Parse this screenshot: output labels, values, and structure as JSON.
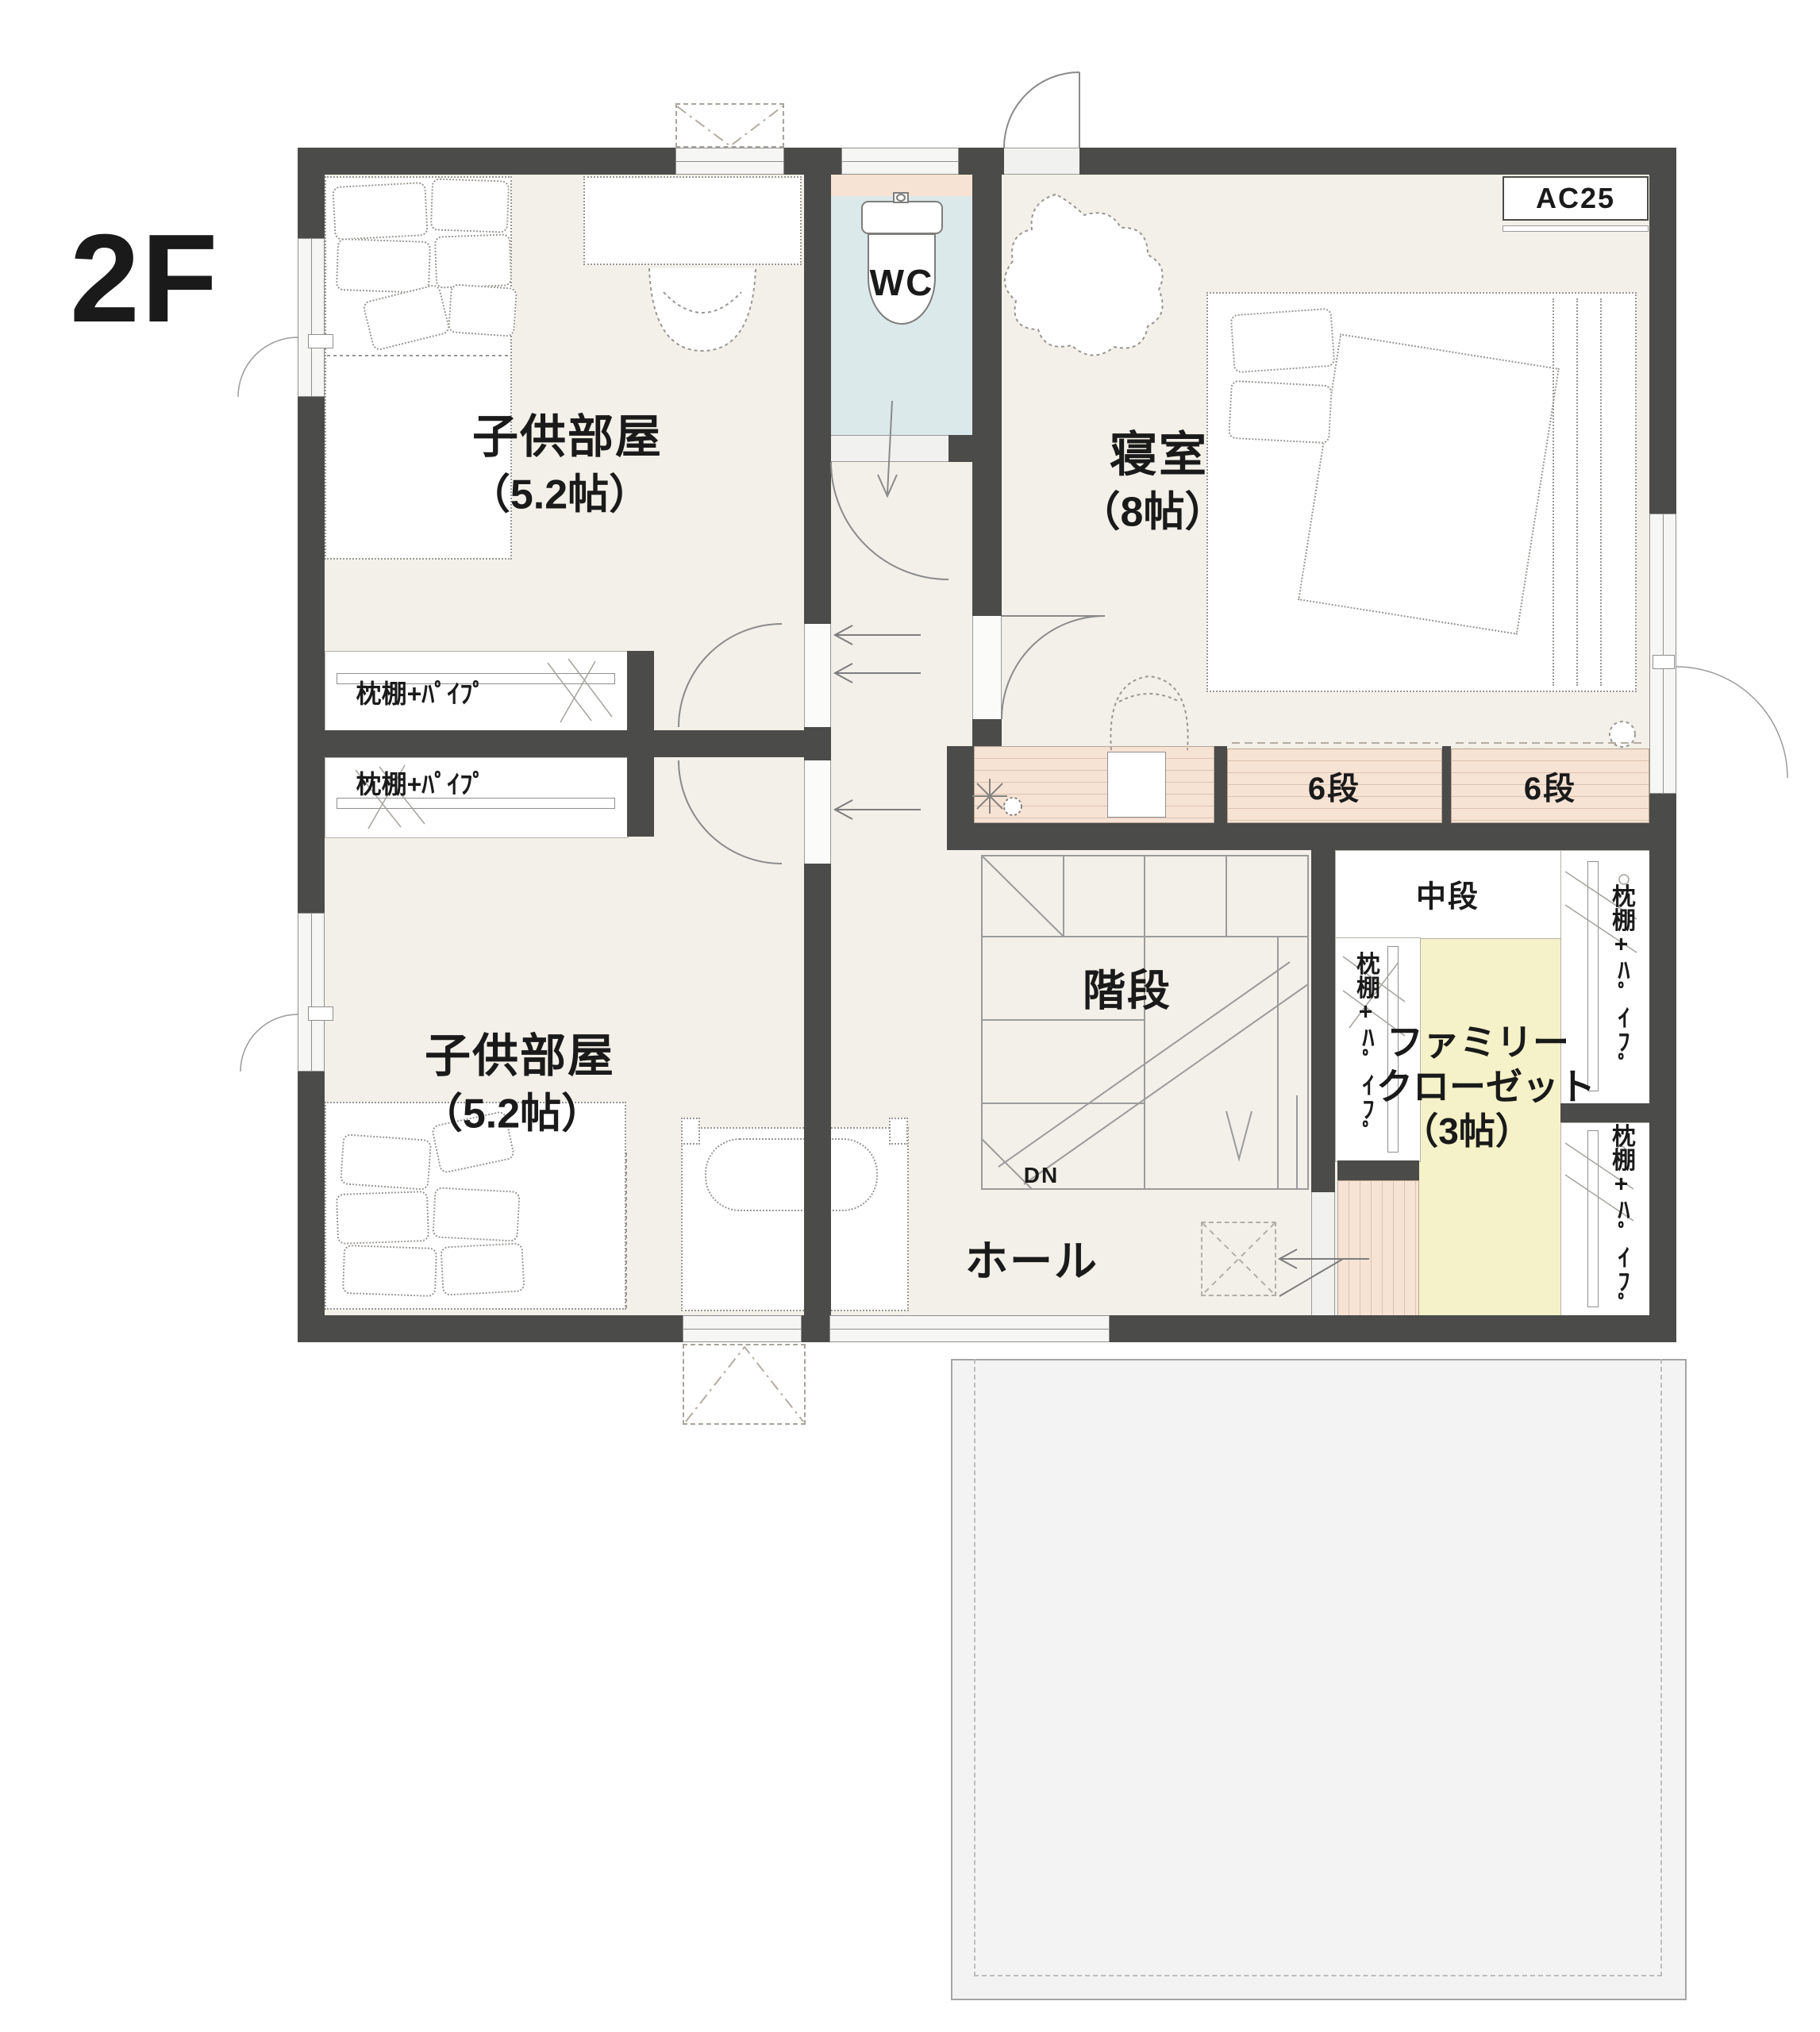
{
  "floor_label": "2F",
  "rooms": {
    "kids_room_1": {
      "name": "子供部屋",
      "size": "（5.2帖）"
    },
    "kids_room_2": {
      "name": "子供部屋",
      "size": "（5.2帖）"
    },
    "bedroom": {
      "name": "寝室",
      "size": "（8帖）"
    },
    "wc": {
      "label": "WC"
    },
    "hall": {
      "label": "ホール"
    },
    "stairs": {
      "label": "階段",
      "down_label": "DN"
    },
    "family_closet": {
      "line1": "ファミリー",
      "line2": "クローゼット",
      "line3": "（3帖）"
    }
  },
  "fixtures": {
    "ac_label": "AC25",
    "shelf_pipe_label": "枕棚+ﾊﾟｲﾌﾟ",
    "six_step_label": "6段",
    "middle_shelf_label": "中段"
  },
  "colors": {
    "wall": "#4b4b49",
    "floor": "#f2f0e8",
    "wc_floor": "#dce9ea",
    "closet_floor": "#f5f1c8",
    "counter_pink": "#f7e3d4",
    "balcony_gray": "#f3f3f3",
    "text": "#1a1a1a"
  }
}
